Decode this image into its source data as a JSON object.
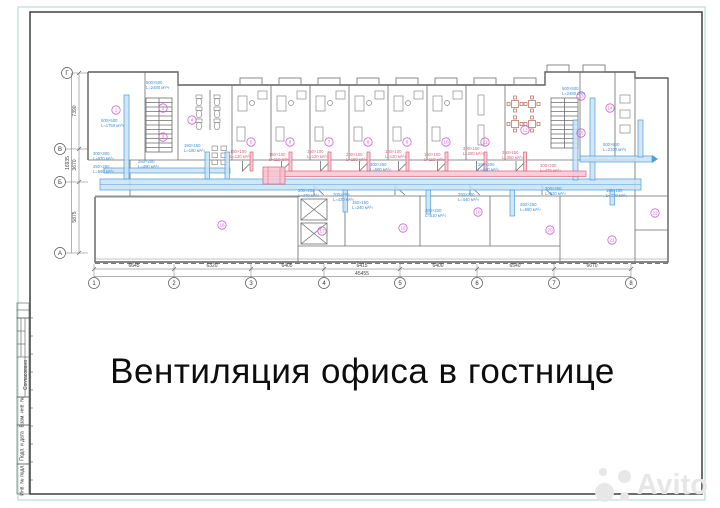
{
  "document": {
    "title": "Вентиляция офиса в гостнице",
    "watermark": "Avito"
  },
  "stamp": {
    "agreed": "Согласовано",
    "cells": [
      "Взам. инв. №",
      "Подп. и дата",
      "Инв. № подл."
    ]
  },
  "plan": {
    "axes_bottom": [
      "1",
      "2",
      "3",
      "4",
      "5",
      "6",
      "7",
      "8"
    ],
    "axes_left": [
      "Г",
      "В",
      "Б",
      "А"
    ],
    "dims_bottom": [
      "6645",
      "6320",
      "6405",
      "6415",
      "6400",
      "6540",
      "6670"
    ],
    "dim_total_bottom": "45455",
    "dims_left": [
      "7390",
      "3670",
      "5875"
    ],
    "dim_total_left": "16935",
    "room_numbers": [
      "1",
      "2",
      "3",
      "4",
      "5",
      "6",
      "7",
      "8",
      "9",
      "10",
      "11",
      "12",
      "13",
      "14",
      "15",
      "16",
      "17",
      "18",
      "19",
      "20",
      "21",
      "22"
    ],
    "duct_labels_blue": [
      {
        "size": "500×500",
        "flow": "L=2480 м³/ч"
      },
      {
        "size": "500×500",
        "flow": "L=1750 м³/ч"
      },
      {
        "size": "300×300",
        "flow": "L=870 м³/ч"
      },
      {
        "size": "250×250",
        "flow": "L=560 м³/ч"
      },
      {
        "size": "250×200",
        "flow": "L=490 м³/ч"
      },
      {
        "size": "150×150",
        "flow": "L=180 м³/ч"
      },
      {
        "size": "200×200",
        "flow": "L=470 м³/ч"
      },
      {
        "size": "200×200",
        "flow": "L=420 м³/ч"
      },
      {
        "size": "150×150",
        "flow": "L=240 м³/ч"
      },
      {
        "size": "200×200",
        "flow": "L=510 м³/ч"
      },
      {
        "size": "250×200",
        "flow": "L=440 м³/ч"
      },
      {
        "size": "250×250",
        "flow": "L=680 м³/ч"
      },
      {
        "size": "150×150",
        "flow": "L=230 м³/ч"
      },
      {
        "size": "500×500",
        "flow": "L=2480 м³/ч"
      },
      {
        "size": "500×500",
        "flow": "L=2100 м³/ч"
      },
      {
        "size": "300×250",
        "flow": "L=590 м³/ч"
      },
      {
        "size": "250×200",
        "flow": "L=440 м³/ч"
      },
      {
        "size": "300×250",
        "flow": "L=620 м³/ч"
      }
    ],
    "duct_labels_red": [
      {
        "size": "150×100",
        "flow": "L=120 м³/ч"
      },
      {
        "size": "150×100",
        "flow": "L=110 м³/ч"
      },
      {
        "size": "150×100",
        "flow": "L=120 м³/ч"
      },
      {
        "size": "200×100",
        "flow": "L=150 м³/ч"
      },
      {
        "size": "150×100",
        "flow": "L=120 м³/ч"
      },
      {
        "size": "150×100",
        "flow": "L=110 м³/ч"
      },
      {
        "size": "200×150",
        "flow": "L=280 м³/ч"
      },
      {
        "size": "250×150",
        "flow": "L=350 м³/ч"
      },
      {
        "size": "300×200",
        "flow": "L=470 м³/ч"
      }
    ],
    "colors": {
      "supply_duct": "#4f9fd4",
      "supply_fill": "#c9e2f4",
      "exhaust_duct": "#e0607c",
      "exhaust_fill": "#f6c6d4",
      "room_mark": "#cf5fd0",
      "frame_outer": "#a9d8d0",
      "frame_inner": "#4a4a4a",
      "walls": "#5f5f5f"
    }
  }
}
